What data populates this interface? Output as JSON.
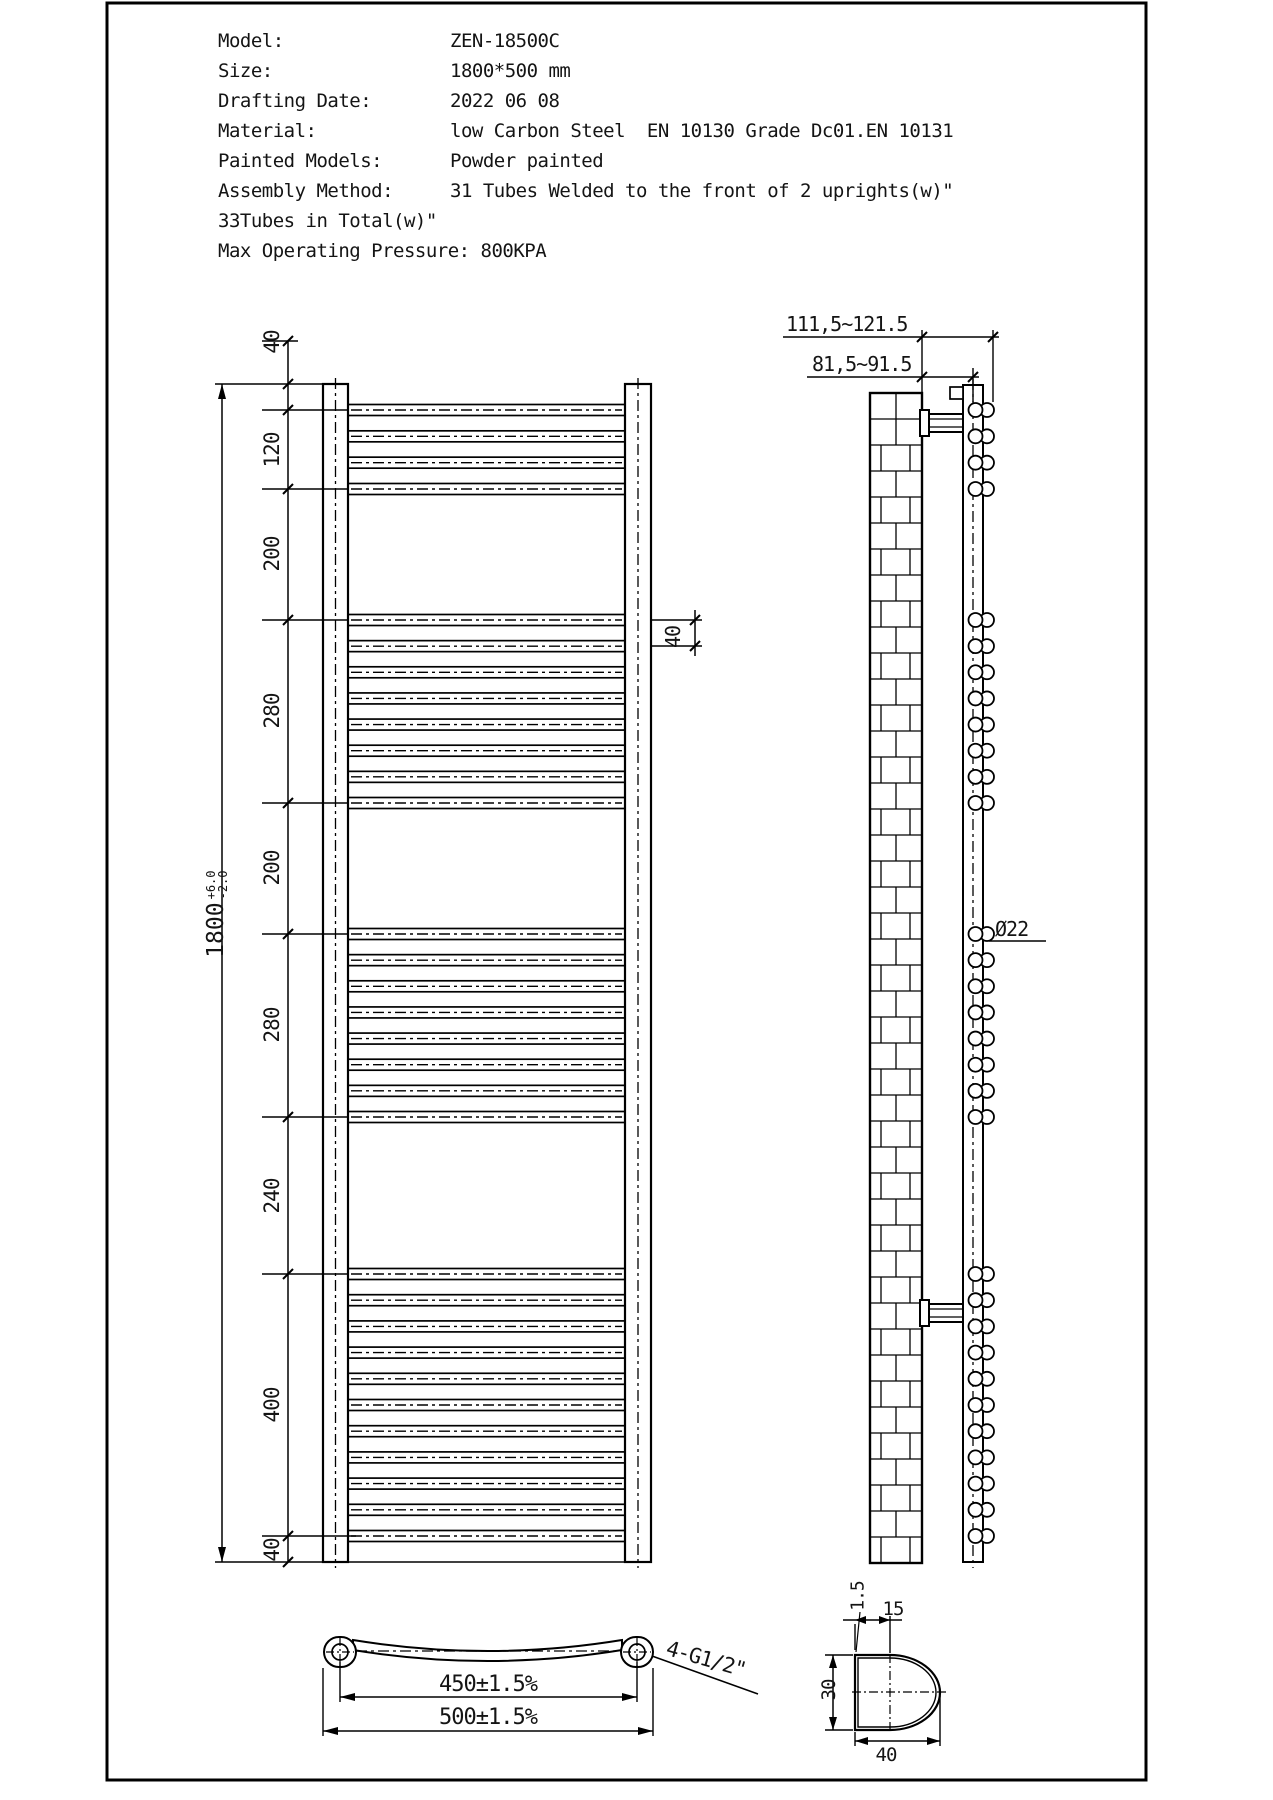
{
  "title_block": {
    "rows": [
      {
        "label": "Model:",
        "value": "ZEN-18500C"
      },
      {
        "label": "Size:",
        "value": "1800*500 mm"
      },
      {
        "label": "Drafting Date:",
        "value": "2022 06 08"
      },
      {
        "label": "Material:",
        "value": "low Carbon Steel  EN 10130 Grade Dc01.EN 10131"
      },
      {
        "label": "Painted Models:",
        "value": "Powder painted"
      },
      {
        "label": "Assembly Method:",
        "value": "31 Tubes Welded to the front of 2 uprights(w)\""
      }
    ],
    "note": "33Tubes in Total(w)\"",
    "pressure_line": "Max Operating Pressure: 800KPA"
  },
  "front_view": {
    "chain_labels": [
      "40",
      "120",
      "200",
      "280",
      "200",
      "280",
      "240",
      "400",
      "40"
    ],
    "overall": {
      "value": "1800",
      "tol_plus": "+6.0",
      "tol_minus": "-2.0"
    },
    "pitch_label": "40",
    "tube_groups": [
      4,
      8,
      8,
      11
    ]
  },
  "side_view": {
    "dim_wall_to_front": "111,5~121.5",
    "dim_wall_to_upright": "81,5~91.5",
    "tube_diameter": "Ø22"
  },
  "bottom_view": {
    "dim_centers": "450±1.5%",
    "dim_overall": "500±1.5%",
    "thread_note": "4-G1/2\""
  },
  "detail_view": {
    "wall_thickness": "1.5",
    "flat_width": "15",
    "depth": "30",
    "width": "40"
  }
}
